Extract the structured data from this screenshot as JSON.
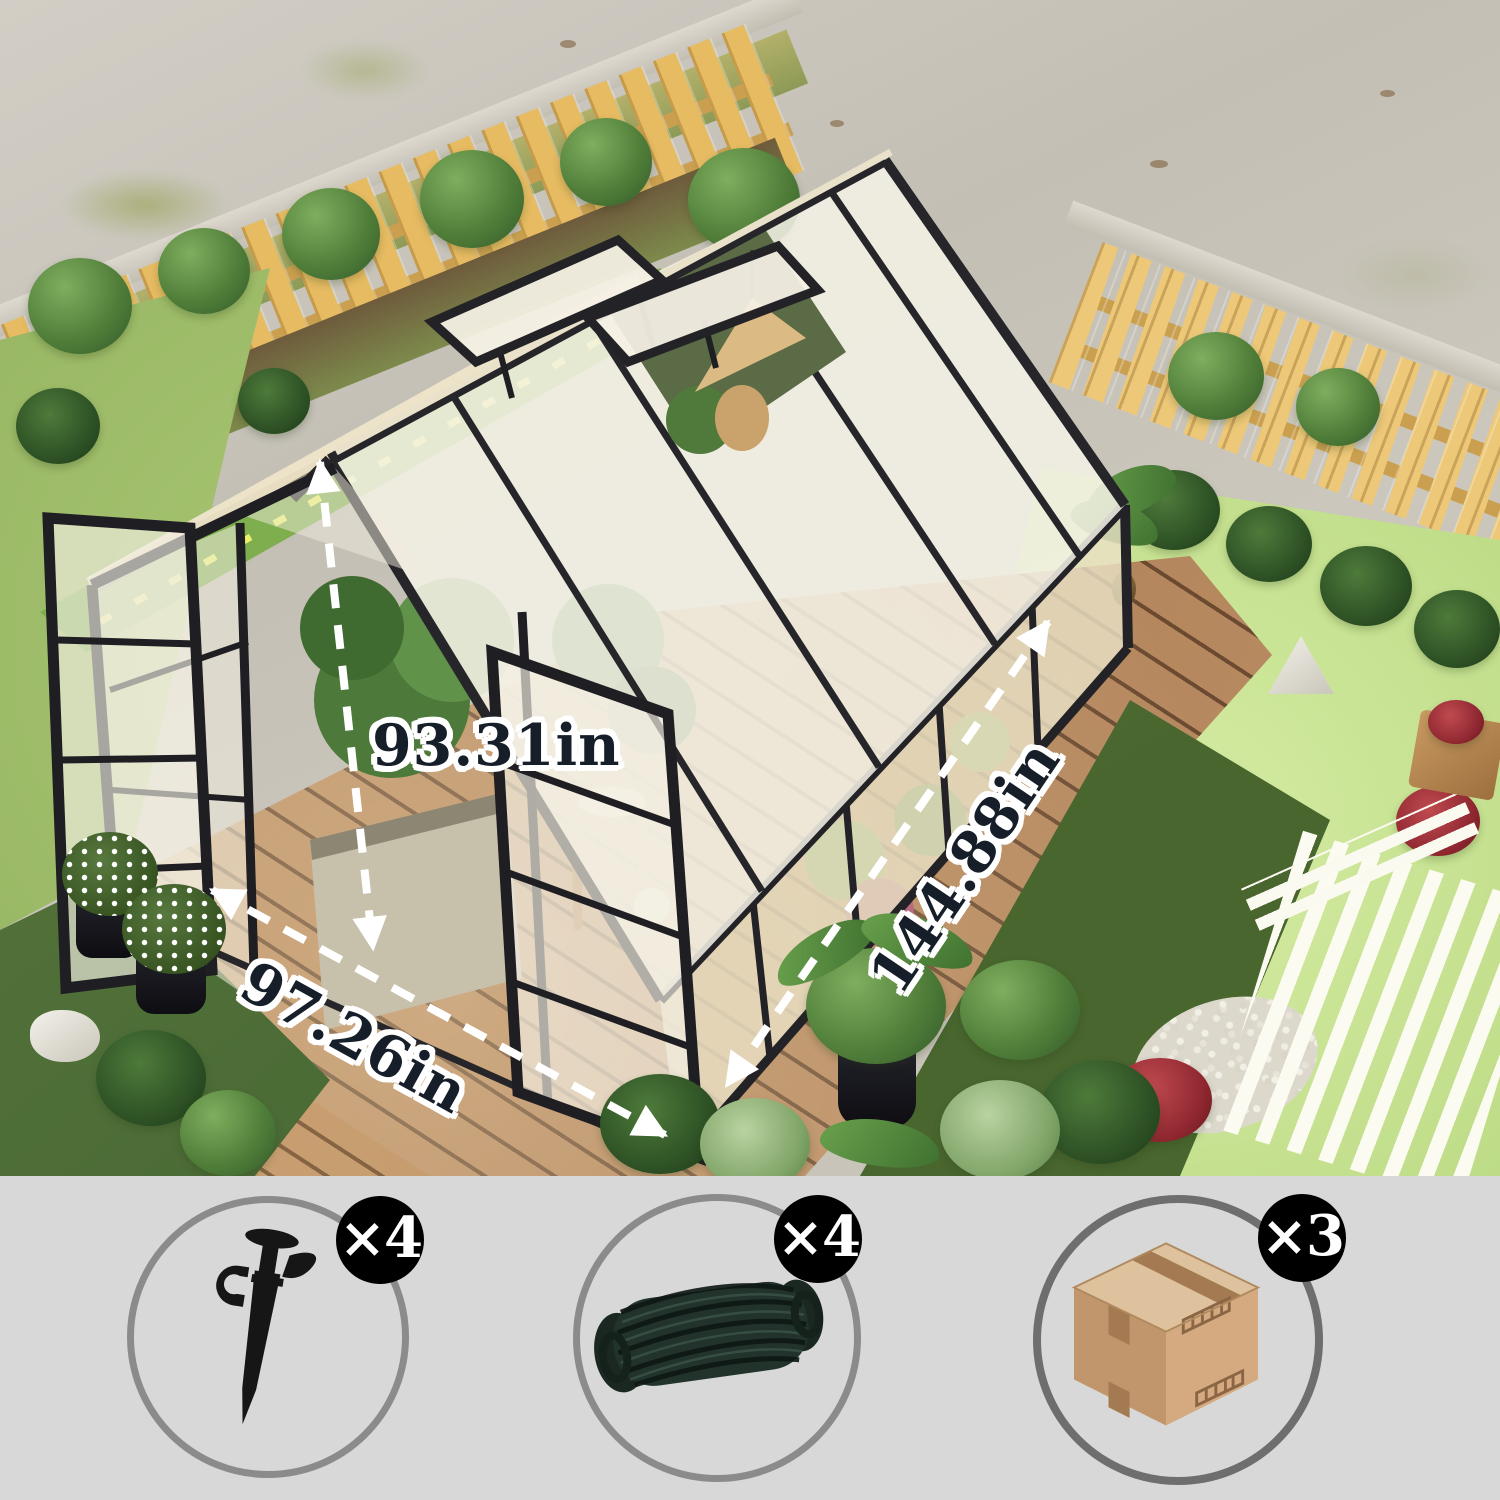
{
  "scene": {
    "description": "aerial view of black-frame polycarbonate greenhouse on wooden deck in backyard",
    "dimensions": {
      "height": {
        "label": "93.31in"
      },
      "width": {
        "label": "97.26in"
      },
      "depth": {
        "label": "144.88in"
      }
    }
  },
  "parts": {
    "items": [
      {
        "name": "ground-stake",
        "icon": "stake-icon",
        "count_label": "×4"
      },
      {
        "name": "tie-down-rope",
        "icon": "rope-icon",
        "count_label": "×4"
      },
      {
        "name": "package-box",
        "icon": "box-icon",
        "count_label": "×3"
      }
    ]
  },
  "colors": {
    "band_bg": "#d8d8d8",
    "circle_stroke": "#8b8b8b",
    "badge_bg": "#000000",
    "badge_text": "#ffffff",
    "dimension_text": "#161f29",
    "dimension_outline": "#ffffff",
    "frame": "#26262a",
    "fascia": "#e9e1ca"
  }
}
